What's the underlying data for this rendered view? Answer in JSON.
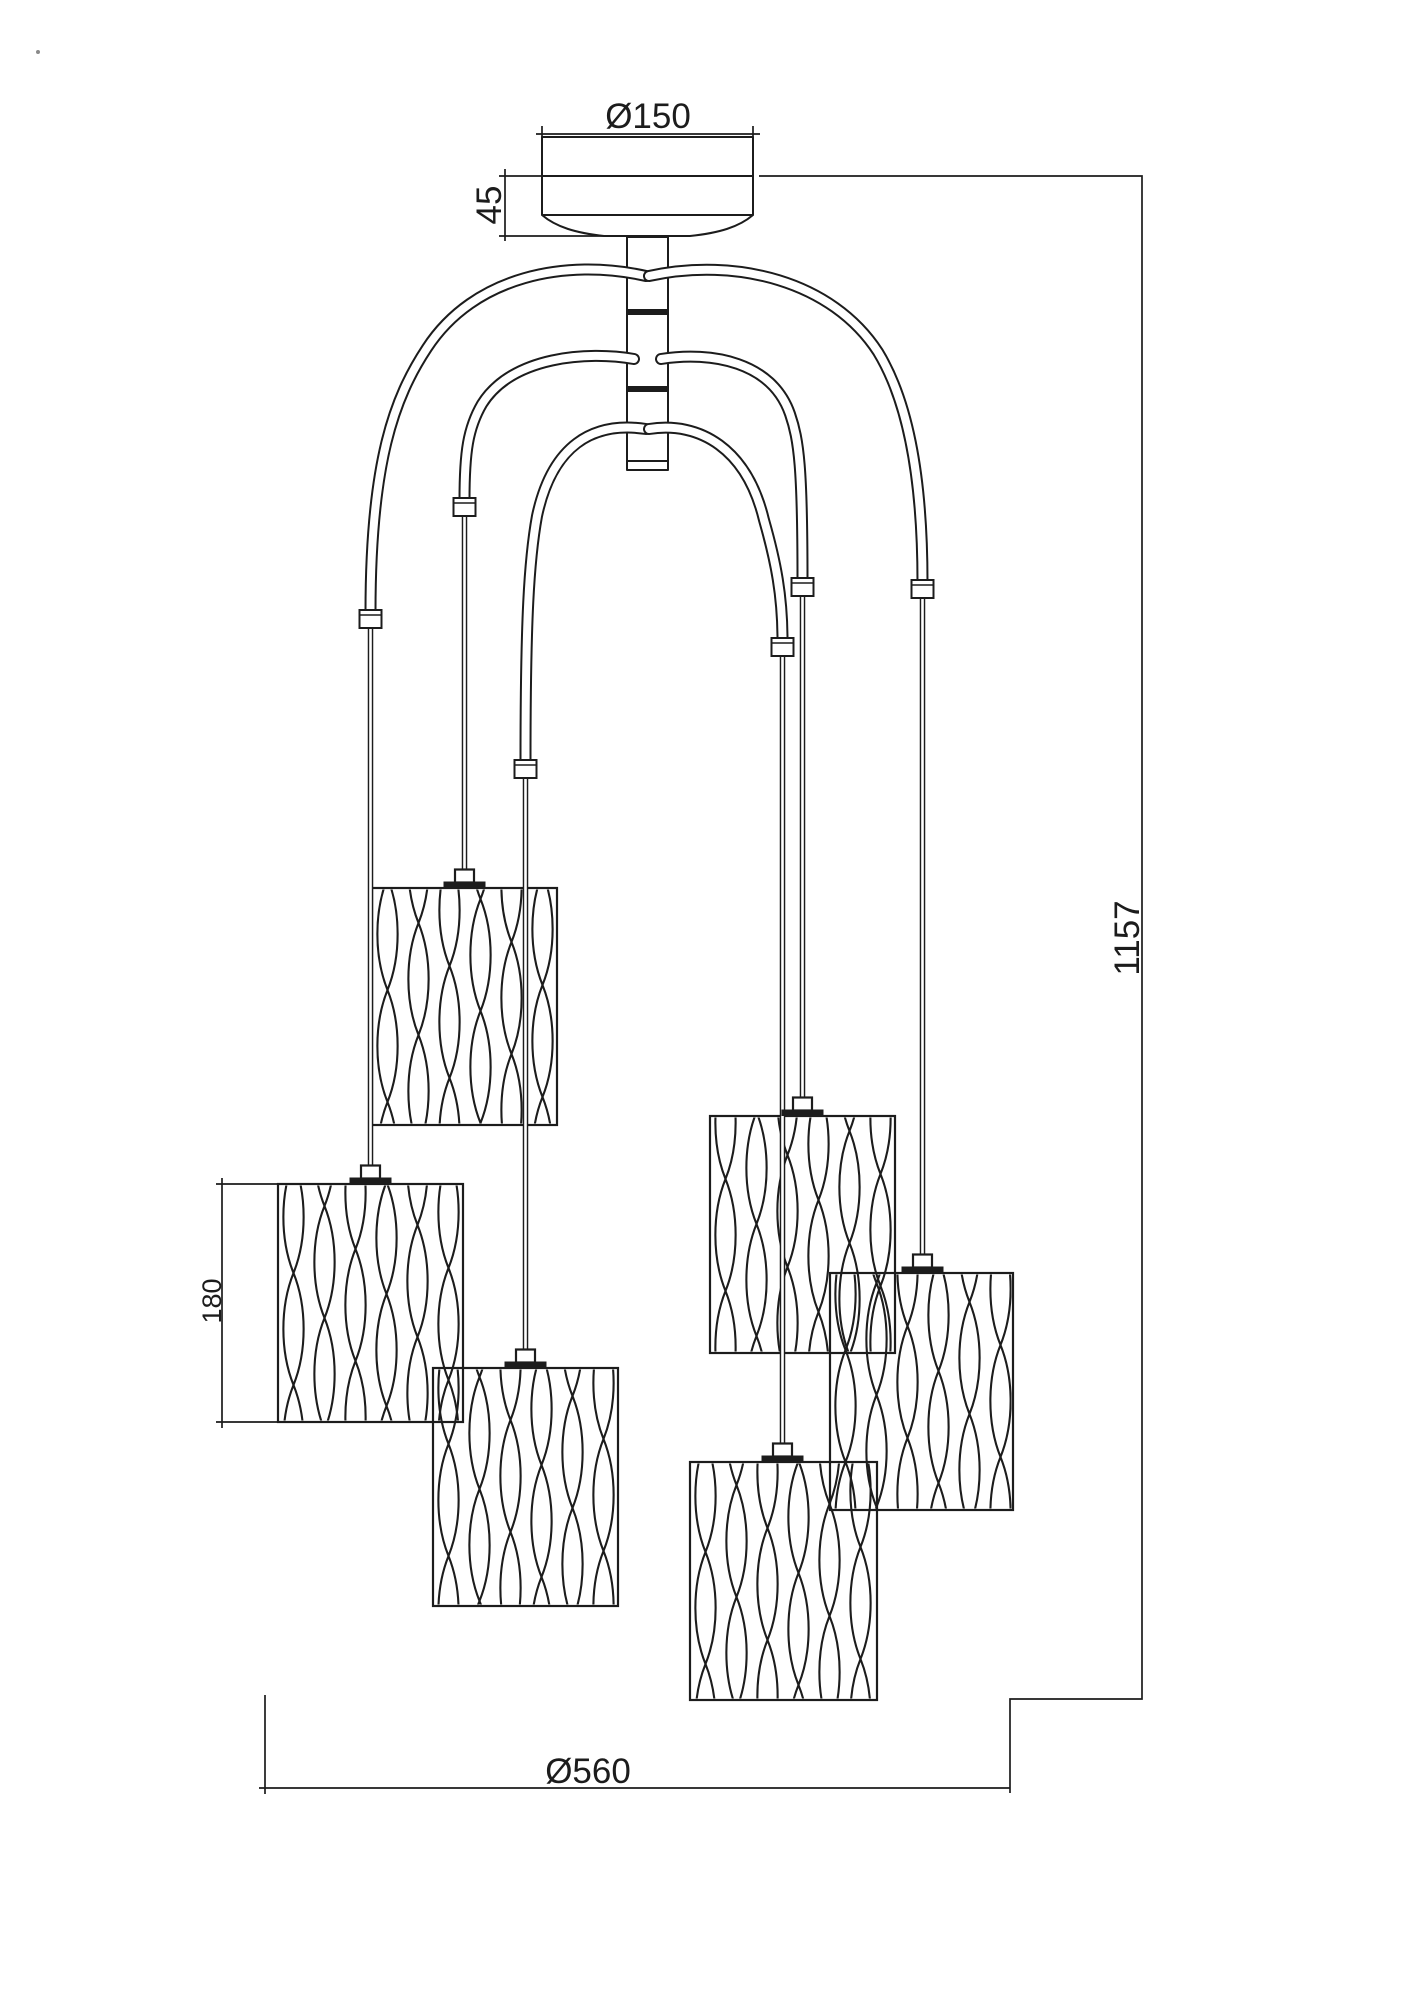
{
  "page": {
    "background": "#ffffff",
    "line_color": "#1c1c1c"
  },
  "drawing": {
    "shade_count": 6,
    "arm_count": 6
  },
  "dimensions": {
    "canopy_diameter": "Ø150",
    "canopy_height": "45",
    "overall_height": "1157",
    "shade_height": "180",
    "overall_diameter": "Ø560"
  }
}
